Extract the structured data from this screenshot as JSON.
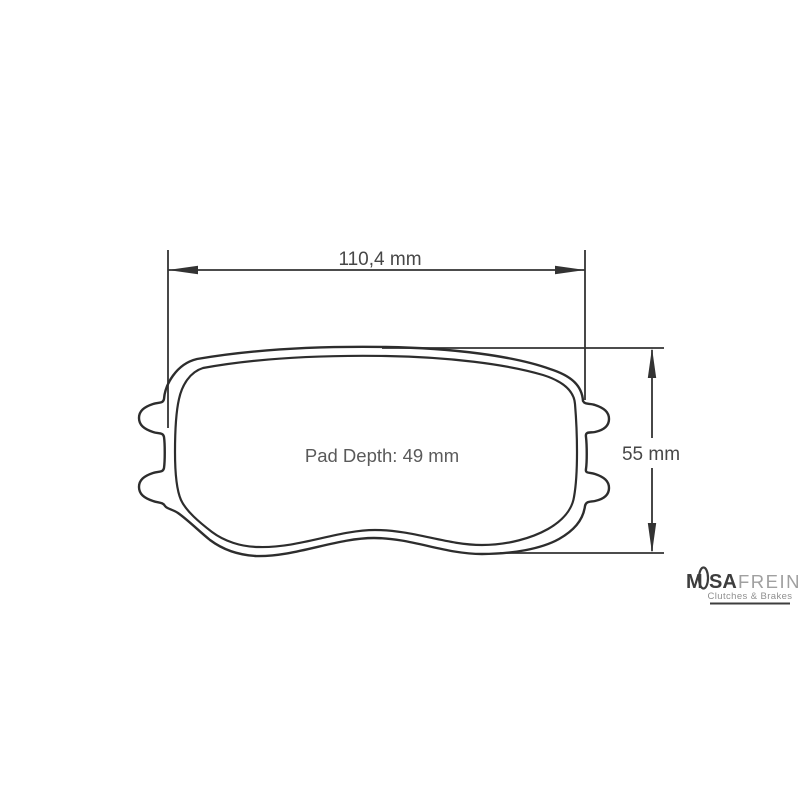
{
  "diagram": {
    "title": "brake-pad-dimension-drawing",
    "width_dimension_label": "110,4 mm",
    "height_dimension_label": "55 mm",
    "pad_depth_label": "Pad Depth: 49 mm"
  },
  "logo": {
    "part_m": "M",
    "part_sa": "SA",
    "part_frein": "FREIN",
    "tagline": "Clutches & Brakes"
  },
  "colors": {
    "line": "#2d2d2d",
    "dimension_line": "#333333",
    "dimension_text": "#474747",
    "pad_depth_text": "#5a5a5a",
    "logo_dark": "#3d3d3d",
    "logo_light": "#a0a0a0",
    "logo_tagline": "#8f8f8f",
    "background": "#ffffff"
  }
}
